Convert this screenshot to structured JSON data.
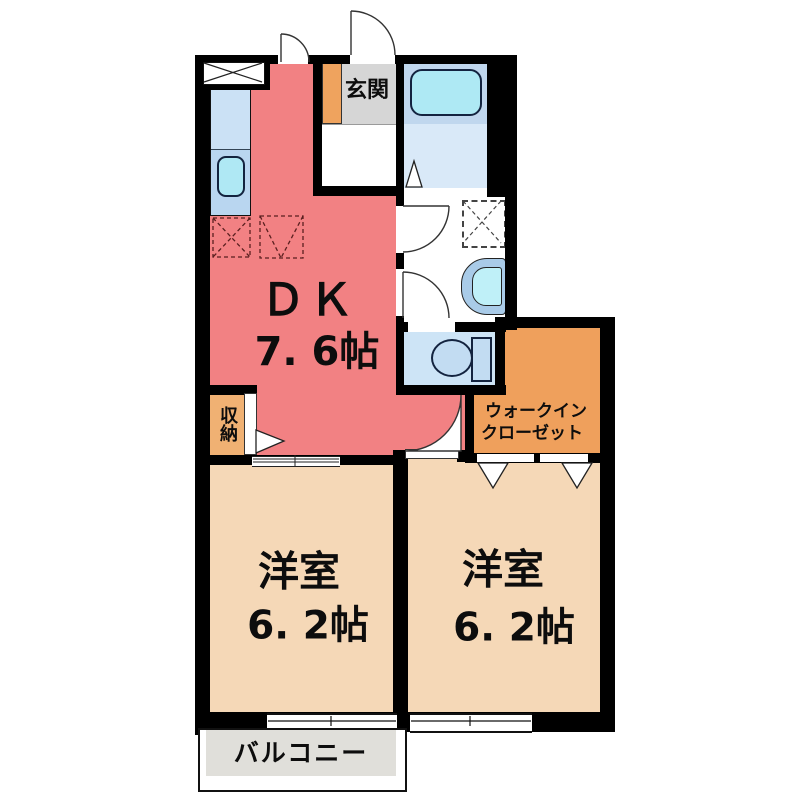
{
  "title": "apartment floor plan",
  "rooms": {
    "dk": {
      "label": "ＤＫ",
      "size": "7. 6帖"
    },
    "genkan": {
      "label": "玄関"
    },
    "bedroom_left": {
      "label": "洋室",
      "size": "6. 2帖"
    },
    "bedroom_right": {
      "label": "洋室",
      "size": "6. 2帖"
    },
    "walk_in_closet": {
      "label_line1": "ウォークイン",
      "label_line2": "クローゼット"
    },
    "storage": {
      "label": "収納"
    },
    "balcony": {
      "label": "バルコニー"
    }
  },
  "fixtures": [
    "kitchen-counter",
    "kitchen-sink",
    "range-hood",
    "refrigerator-space",
    "washing-machine-space",
    "bathtub",
    "washbasin",
    "toilet",
    "entrance-door",
    "hinged-doors",
    "folding-doors",
    "sliding-door",
    "sliding-windows"
  ],
  "colors": {
    "dk_fill": "#F28183",
    "bedroom_fill": "#F5D8B7",
    "closet_fill": "#EFA05C",
    "storage_fill": "#F0B173",
    "genkan_floor": "#D6D6D6",
    "shoe_cabinet": "#EFA35E",
    "water_room_fill": "#CDE4F6",
    "bathtub_fill": "#AEE9F4",
    "balcony_fill": "#E0DFDA",
    "wall": "#000000"
  }
}
